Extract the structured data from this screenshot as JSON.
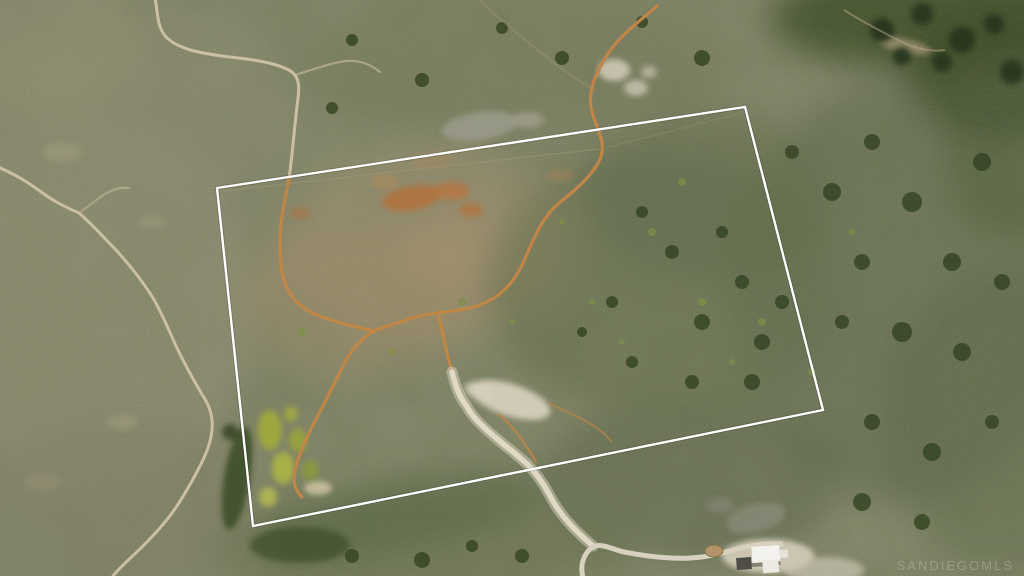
{
  "scene": {
    "description": "Aerial drone photograph of undeveloped chaparral land with a white property-boundary outline, dirt trails, a sandy wash, access roads and a small house at lower right",
    "width_px": 1024,
    "height_px": 576
  },
  "watermark": {
    "text": "SANDIEGOMLS"
  },
  "boundary": {
    "points": "217,188 745,107 823,410 253,526",
    "color": "#ffffff"
  },
  "colors": {
    "terrain_base": "#787a5e",
    "trail": "#c08646",
    "wash": "#e3dbc8",
    "road": "#cbc0a4",
    "gravel_road": "#d8d1bf",
    "building_roof": "#f4f2ec"
  }
}
